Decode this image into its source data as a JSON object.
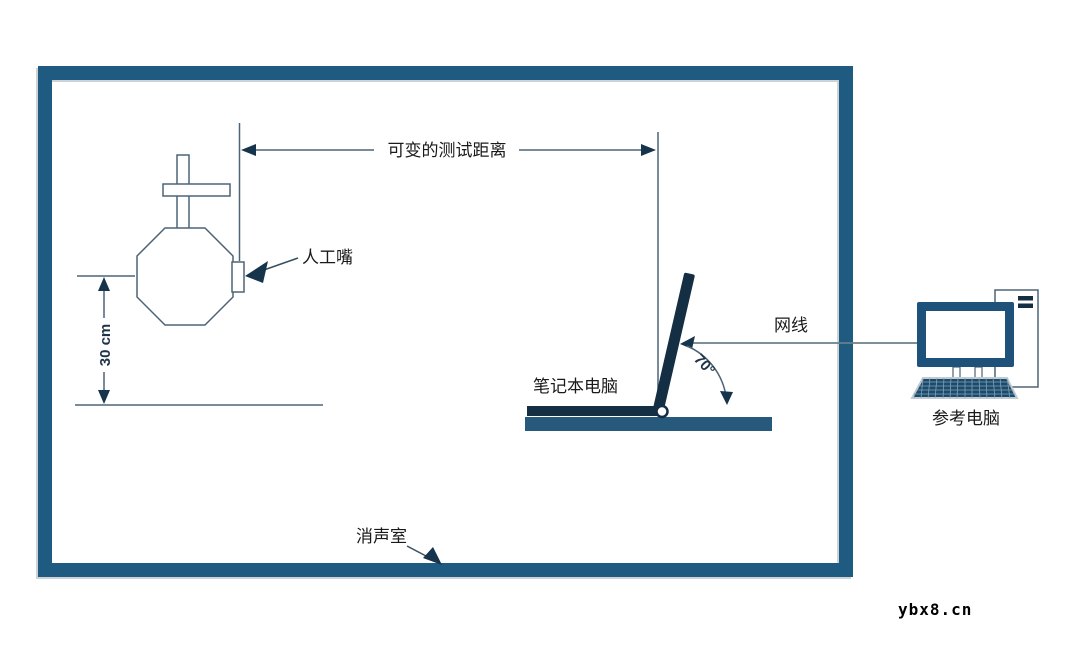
{
  "diagram": {
    "title_context": "anechoic-chamber-headset-test-setup",
    "labels": {
      "test_distance": "可变的测试距离",
      "artificial_mouth": "人工嘴",
      "mouth_height": "30 cm",
      "laptop": "笔记本电脑",
      "network_cable": "网线",
      "screen_angle": "70°",
      "reference_pc": "参考电脑",
      "anechoic_chamber": "消声室"
    },
    "colors": {
      "chamber_border": "#1f5b80",
      "steel_blue_fill": "#26597b",
      "monitor_frame": "#1f527a",
      "dark_navy_fill": "#16344b",
      "pc_keyboard_fill": "#1d4a6a",
      "thin_outline": "#4d6377",
      "cable_gray": "#6b7f8c",
      "label_text": "#1a1a1a",
      "dimension_text": "#1d3348",
      "background": "#ffffff"
    }
  },
  "watermark": {
    "text": "ybx8.cn"
  }
}
